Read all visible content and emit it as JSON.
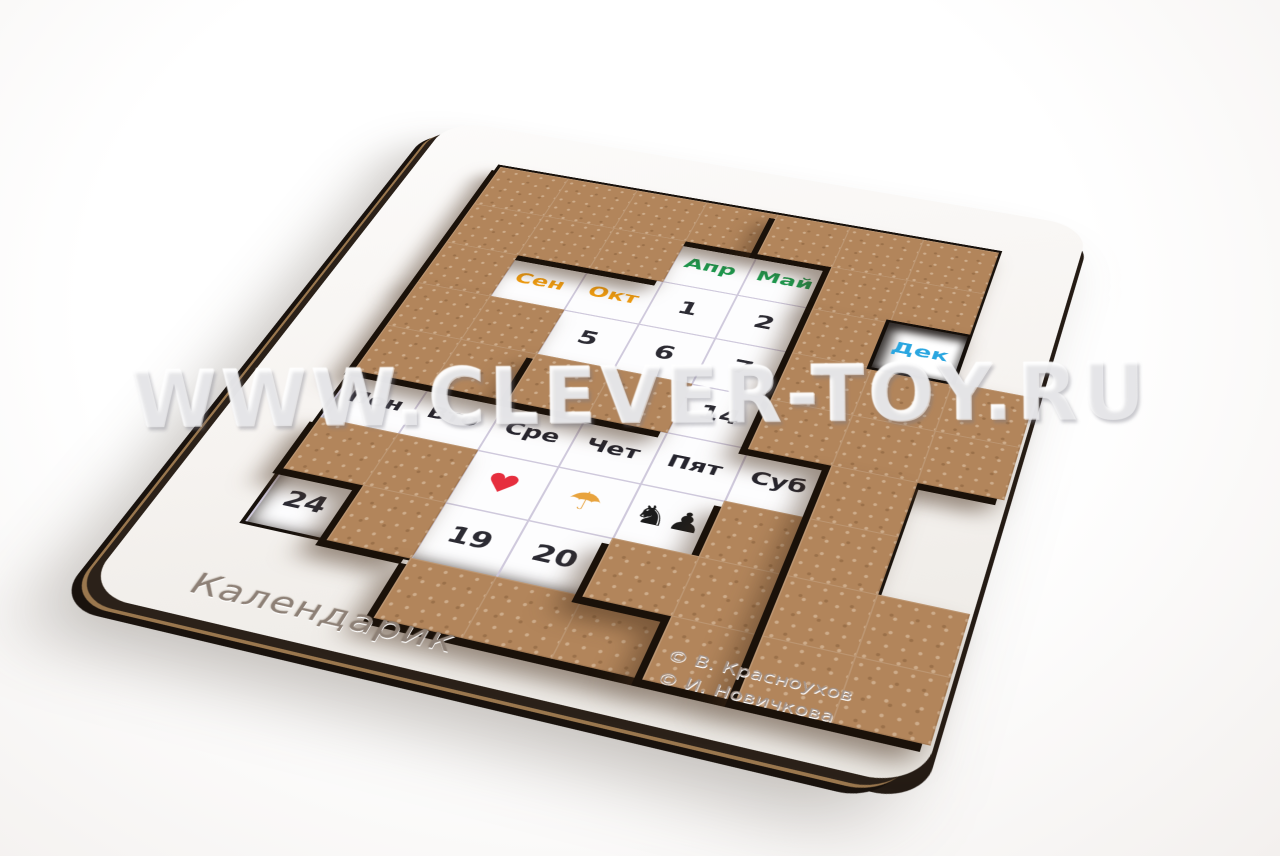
{
  "product": {
    "title": "Календарик",
    "watermark": "WWW.CLEVER-TOY.RU",
    "credits": [
      "© В. Красноухов",
      "© И. Новичкова"
    ]
  },
  "colors": {
    "month_autumn": "#f09c10",
    "month_spring": "#1d9a4e",
    "month_winter": "#2aa6e0",
    "number_text": "#2c2b33",
    "day_text": "#26252e",
    "heart": "#e62e3e",
    "umbrella": "#e8a33d",
    "figures": "#1b1b1b",
    "wood": "#b2855b",
    "board_face": "#f7f5f2"
  },
  "board": {
    "grid": {
      "cols": 7,
      "rows": 8,
      "cell_px": 60
    },
    "cells": [
      {
        "r": 1,
        "c": 3,
        "label": "Апр",
        "type": "month",
        "color": "month_spring"
      },
      {
        "r": 1,
        "c": 4,
        "label": "Май",
        "type": "month",
        "color": "month_spring"
      },
      {
        "r": 2,
        "c": 1,
        "label": "Сен",
        "type": "month",
        "color": "month_autumn"
      },
      {
        "r": 2,
        "c": 2,
        "label": "Окт",
        "type": "month",
        "color": "month_autumn"
      },
      {
        "r": 2,
        "c": 3,
        "label": "1",
        "type": "number",
        "color": "number_text"
      },
      {
        "r": 2,
        "c": 4,
        "label": "2",
        "type": "number",
        "color": "number_text"
      },
      {
        "r": 3,
        "c": 2,
        "label": "5",
        "type": "number",
        "color": "number_text"
      },
      {
        "r": 3,
        "c": 3,
        "label": "6",
        "type": "number",
        "color": "number_text"
      },
      {
        "r": 3,
        "c": 4,
        "label": "7",
        "type": "number",
        "color": "number_text"
      },
      {
        "r": 4,
        "c": 4,
        "label": "14",
        "type": "number",
        "color": "number_text"
      },
      {
        "r": 5,
        "c": 0,
        "label": "Пон",
        "type": "day",
        "color": "day_text"
      },
      {
        "r": 5,
        "c": 1,
        "label": "Вто",
        "type": "day",
        "color": "day_text"
      },
      {
        "r": 5,
        "c": 2,
        "label": "Сре",
        "type": "day",
        "color": "day_text"
      },
      {
        "r": 5,
        "c": 3,
        "label": "Чет",
        "type": "day",
        "color": "day_text"
      },
      {
        "r": 5,
        "c": 4,
        "label": "Пят",
        "type": "day",
        "color": "day_text"
      },
      {
        "r": 5,
        "c": 5,
        "label": "Суб",
        "type": "day",
        "color": "day_text"
      },
      {
        "r": 6,
        "c": 2,
        "label": "♥",
        "type": "icon",
        "color": "heart",
        "icon": "heart-icon"
      },
      {
        "r": 6,
        "c": 3,
        "label": "☂",
        "type": "icon",
        "color": "umbrella",
        "icon": "beach-umbrella-icon"
      },
      {
        "r": 6,
        "c": 4,
        "label": "♞♟",
        "type": "icon",
        "color": "figures",
        "icon": "figures-icon"
      },
      {
        "r": 7,
        "c": 0,
        "label": "24",
        "type": "number",
        "color": "number_text"
      },
      {
        "r": 7,
        "c": 2,
        "label": "19",
        "type": "number",
        "color": "number_text"
      },
      {
        "r": 7,
        "c": 3,
        "label": "20",
        "type": "number",
        "color": "number_text"
      }
    ],
    "window_cell": {
      "r": 2,
      "c": 6,
      "label": "Дек",
      "type": "month",
      "color": "month_winter"
    },
    "pieces": [
      {
        "id": "a",
        "cells": [
          [
            0,
            0
          ],
          [
            0,
            1
          ],
          [
            0,
            2
          ],
          [
            0,
            3
          ],
          [
            1,
            0
          ],
          [
            1,
            1
          ],
          [
            1,
            2
          ],
          [
            2,
            0
          ]
        ]
      },
      {
        "id": "b",
        "cells": [
          [
            0,
            4
          ],
          [
            0,
            5
          ],
          [
            0,
            6
          ],
          [
            1,
            5
          ],
          [
            1,
            6
          ]
        ]
      },
      {
        "id": "c",
        "cells": [
          [
            2,
            5
          ],
          [
            3,
            5
          ],
          [
            3,
            6
          ],
          [
            3,
            7
          ],
          [
            4,
            5
          ],
          [
            4,
            6
          ],
          [
            4,
            7
          ]
        ],
        "window": true
      },
      {
        "id": "d",
        "cells": [
          [
            3,
            0
          ],
          [
            3,
            1
          ],
          [
            4,
            0
          ],
          [
            4,
            1
          ]
        ]
      },
      {
        "id": "e",
        "cells": [
          [
            4,
            2
          ],
          [
            4,
            3
          ]
        ]
      },
      {
        "id": "f",
        "cells": [
          [
            6,
            0
          ],
          [
            6,
            1
          ],
          [
            7,
            1
          ]
        ]
      },
      {
        "id": "g",
        "cells": [
          [
            8,
            2
          ],
          [
            8,
            3
          ],
          [
            8,
            4
          ]
        ]
      },
      {
        "id": "h",
        "cells": [
          [
            6,
            5
          ],
          [
            7,
            4
          ],
          [
            7,
            5
          ],
          [
            8,
            5
          ]
        ]
      },
      {
        "id": "i",
        "cells": [
          [
            5,
            6
          ],
          [
            6,
            6
          ],
          [
            7,
            6
          ],
          [
            7,
            7
          ],
          [
            8,
            6
          ],
          [
            8,
            7
          ]
        ]
      }
    ]
  }
}
